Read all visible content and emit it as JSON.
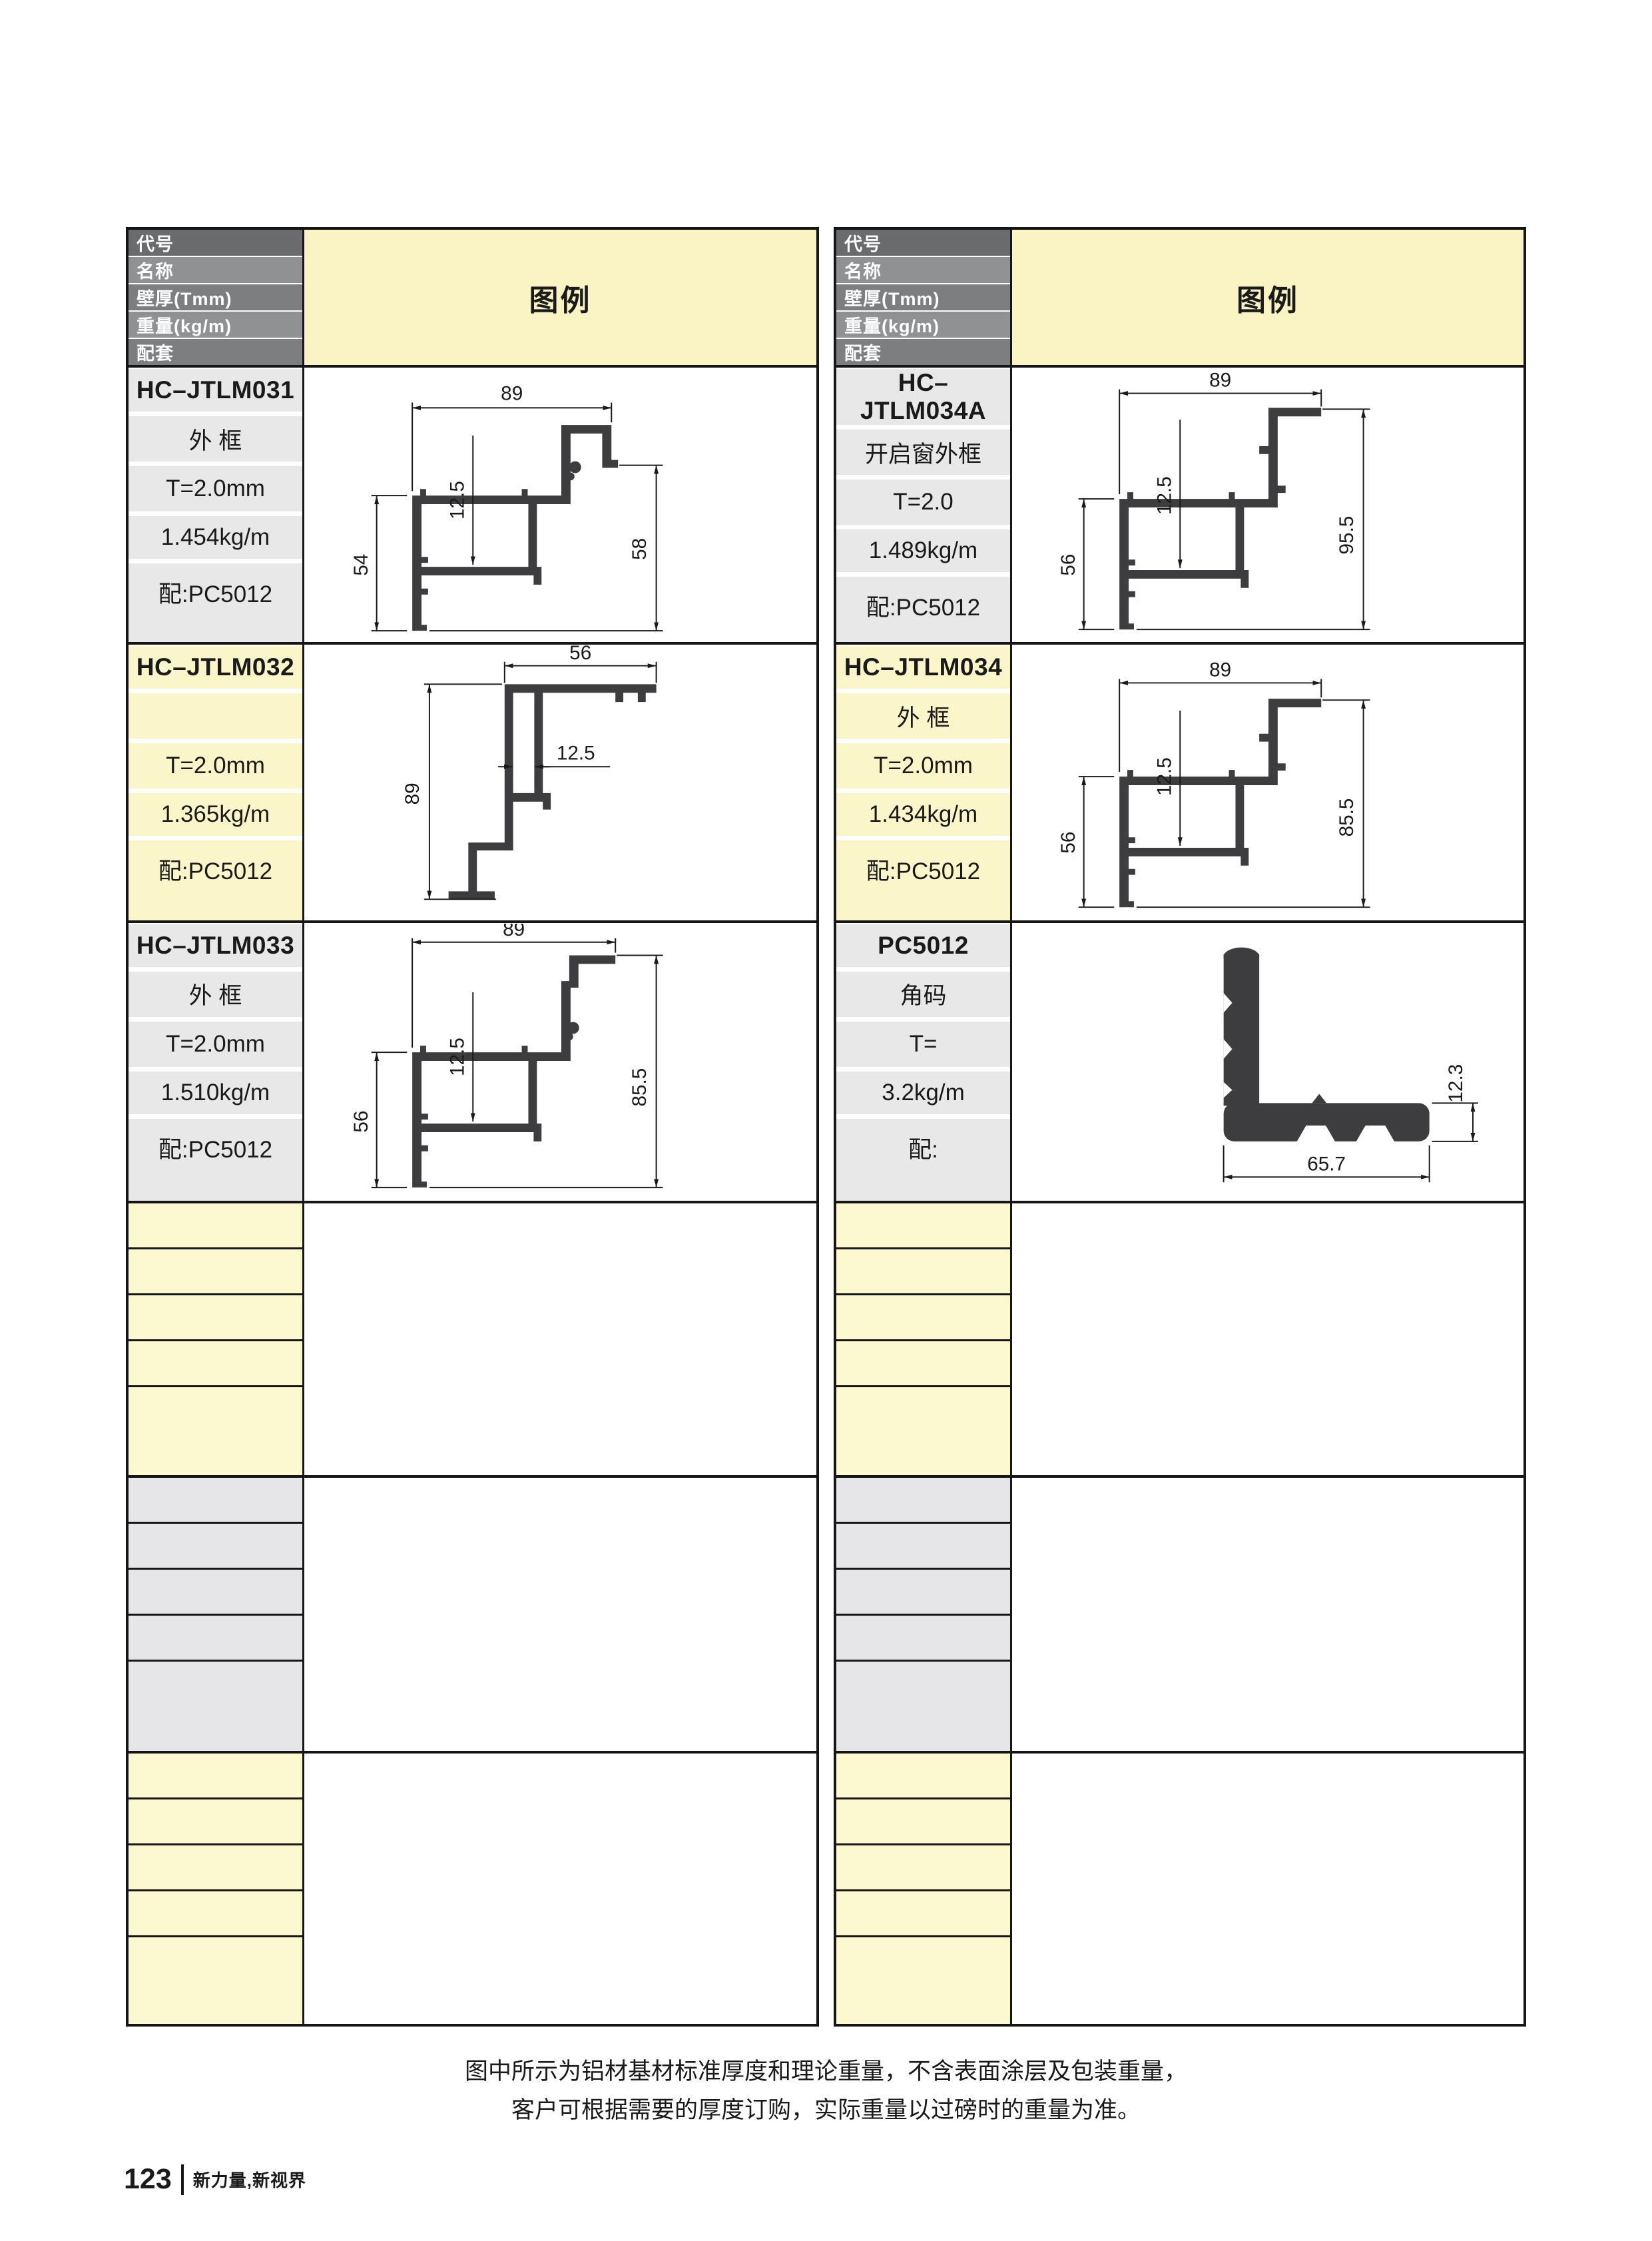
{
  "header": {
    "rows": [
      "代号",
      "名称",
      "壁厚(Tmm)",
      "重量(kg/m)",
      "配套"
    ],
    "legend_label": "图例"
  },
  "products": [
    {
      "code": "HC–JTLM031",
      "name": "外 框",
      "thickness": "T=2.0mm",
      "weight": "1.454kg/m",
      "match": "配:PC5012",
      "dims": {
        "top": "89",
        "inner": "12.5",
        "left": "54",
        "right": "58"
      }
    },
    {
      "code": "HC–JTLM032",
      "name": "",
      "thickness": "T=2.0mm",
      "weight": "1.365kg/m",
      "match": "配:PC5012",
      "dims": {
        "top": "56",
        "inner": "12.5",
        "left": "89"
      }
    },
    {
      "code": "HC–JTLM033",
      "name": "外 框",
      "thickness": "T=2.0mm",
      "weight": "1.510kg/m",
      "match": "配:PC5012",
      "dims": {
        "top": "89",
        "inner": "12.5",
        "left": "56",
        "right": "85.5"
      }
    },
    {
      "code": "HC–JTLM034A",
      "name": "开启窗外框",
      "thickness": "T=2.0",
      "weight": "1.489kg/m",
      "match": "配:PC5012",
      "dims": {
        "top": "89",
        "inner": "12.5",
        "left": "56",
        "right": "95.5"
      }
    },
    {
      "code": "HC–JTLM034",
      "name": "外 框",
      "thickness": "T=2.0mm",
      "weight": "1.434kg/m",
      "match": "配:PC5012",
      "dims": {
        "top": "89",
        "inner": "12.5",
        "left": "56",
        "right": "85.5"
      }
    },
    {
      "code": "PC5012",
      "name": "角码",
      "thickness": "T=",
      "weight": "3.2kg/m",
      "match": "配:",
      "dims": {
        "bottom": "65.7",
        "right": "12.3"
      }
    }
  ],
  "footer": {
    "note_line1": "图中所示为铝材基材标准厚度和理论重量，不含表面涂层及包装重量，",
    "note_line2": "客户可根据需要的厚度订购，实际重量以过磅时的重量为准。",
    "page_number": "123",
    "slogan": "新力量,新视界"
  },
  "colors": {
    "header_dark": "#6a6b6d",
    "header_mid": "#7c7e80",
    "header_light": "#8f9193",
    "legend_bg": "#faf4c5",
    "label_gray": "#e8e8e8",
    "label_yellow": "#fbf6ca",
    "empty_yellow": "#fcf8cf",
    "empty_gray": "#e6e6e8",
    "line": "#1a1a1a",
    "profile": "#3d3d3f"
  }
}
